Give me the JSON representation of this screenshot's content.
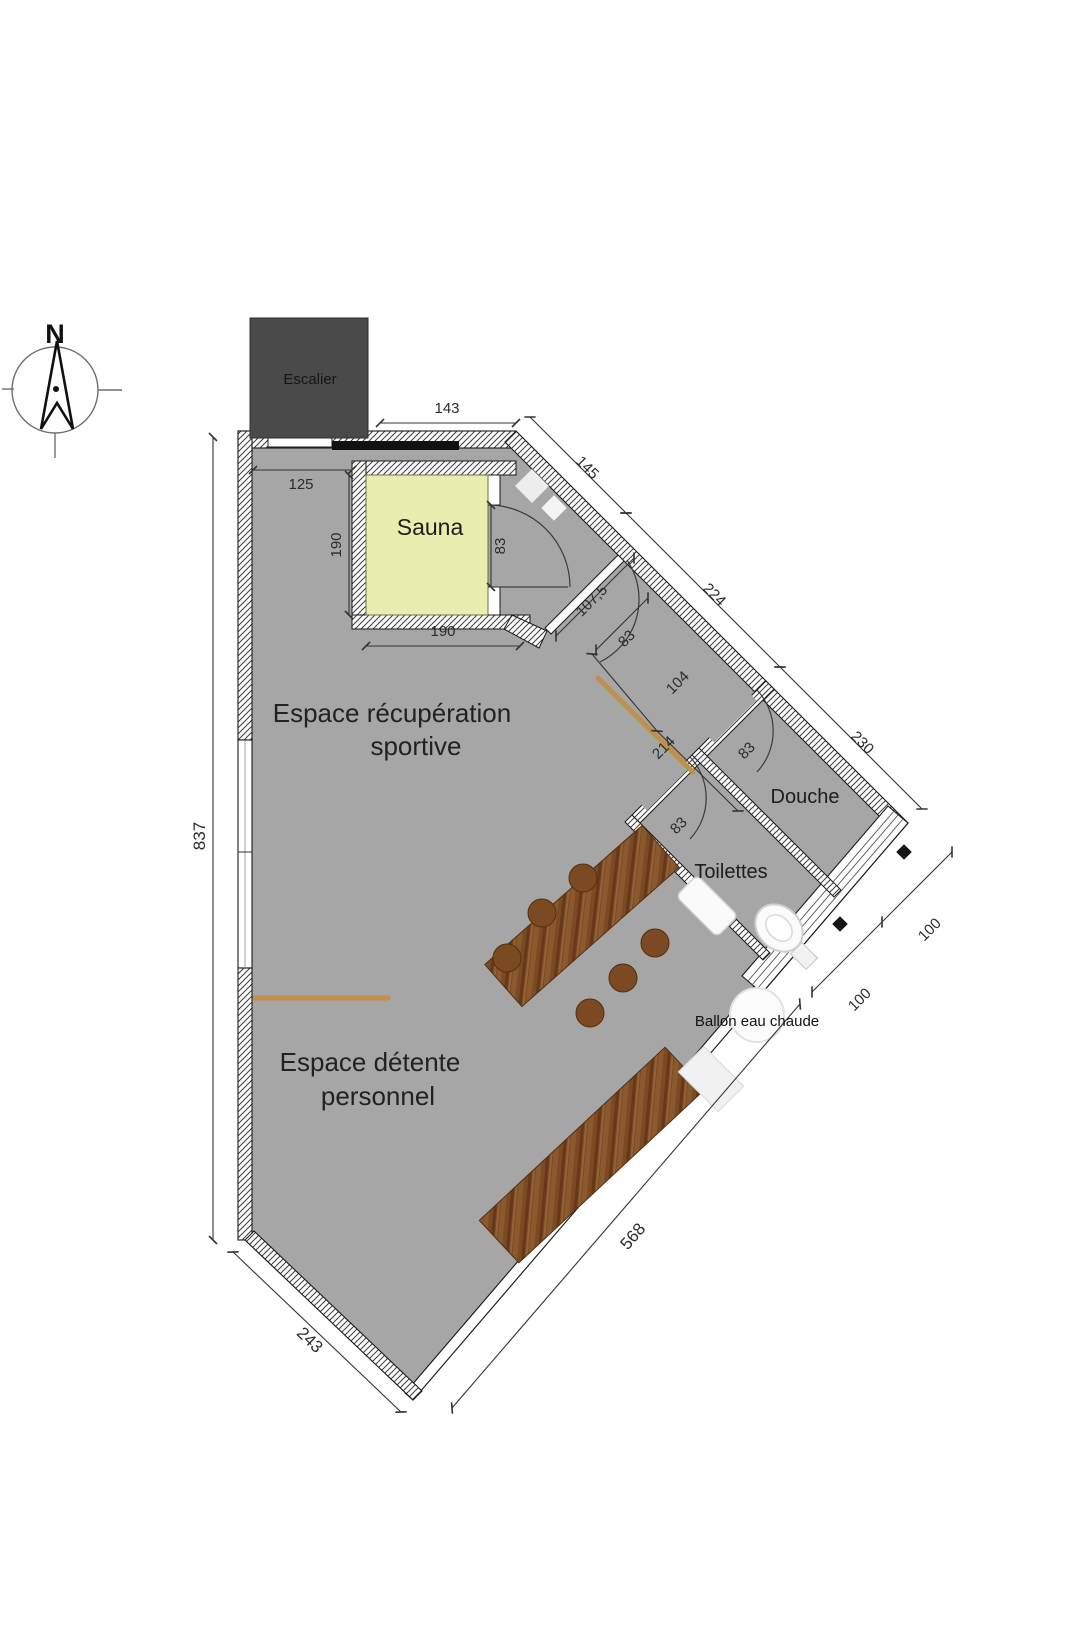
{
  "plan": {
    "compass": {
      "north_label": "N"
    },
    "rooms": {
      "escalier": "Escalier",
      "sauna": "Sauna",
      "recuperation_line1": "Espace récupération",
      "recuperation_line2": "sportive",
      "detente_line1": "Espace détente",
      "detente_line2": "personnel",
      "douche": "Douche",
      "toilettes": "Toilettes",
      "ballon_eau_chaude": "Ballon eau chaude"
    },
    "dimensions": {
      "top_opening": "143",
      "interior_top": "125",
      "sauna_height": "190",
      "sauna_width": "190",
      "sauna_door": "83",
      "left_wall": "837",
      "diag_wall_1": "145",
      "diag_wall_2": "224",
      "diag_wall_3": "230",
      "vestibule_wall": "107,5",
      "vestibule_door": "83",
      "passage_1": "104",
      "passage_2": "214",
      "douche_door": "83",
      "toilettes_door": "83",
      "douche_width": "100",
      "toilettes_width": "100",
      "southeast_wall": "568",
      "southwest_wall": "243"
    },
    "colors": {
      "floor": "#a6a6a6",
      "sauna_fill": "#e9edb0",
      "stair_fill": "#4a4a4a",
      "wood": "#7b4a23",
      "accent_line": "#c08f48"
    }
  }
}
